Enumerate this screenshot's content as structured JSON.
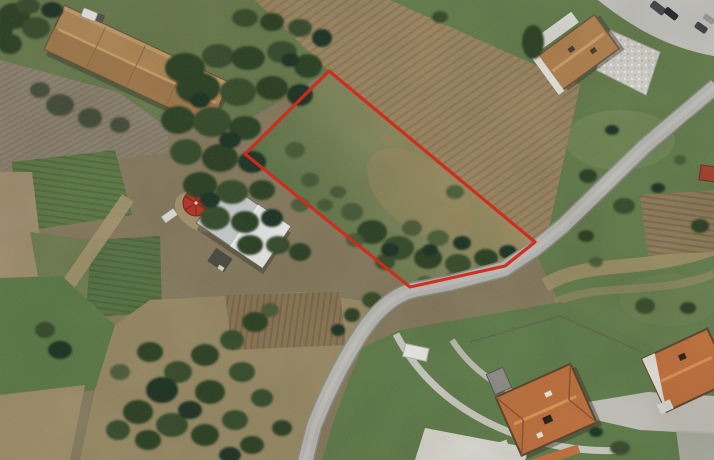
{
  "scene": {
    "type": "aerial-satellite-photo",
    "description": "Rural hillside with farm buildings, cultivated fields, a curving road and a land parcel outlined in red",
    "parcel_boundary": {
      "color": "#d32a1c",
      "stroke_width": 3.2,
      "points": "329,71 535,242 505,266 410,287 245,154"
    },
    "road": {
      "color": "#b8b8b4",
      "edge_color": "#8e8e88",
      "highlight": "#c9c9c5"
    },
    "buildings": {
      "barn_roof": "#b08756",
      "white_house_roof": "#c9ced1",
      "tan_house_roof": "#b3824f",
      "orange_house_roof": "#bf6f3b",
      "hut_roof": "#a33f2a",
      "umbrella": "#b83326"
    },
    "terrain": {
      "grass": "#627c4b",
      "grass_light": "#7c8f5d",
      "dry_field": "#978964",
      "plowed_field": "#9b8560",
      "plowed_gray": "#8c8270",
      "trees": "#2b4024"
    },
    "features": [
      "long farm barn with tan roof (top left)",
      "white-roof farmhouse with red round canopy (center left)",
      "tan-roof house with cobbled patio and parked cars (top right)",
      "two orange-roof houses with driveway and terraced garden (bottom right)",
      "gray country road crossing diagonally",
      "red boundary outline of grassy parcel (center)",
      "crop rows and plowed fields (left)",
      "tree clusters throughout"
    ],
    "vehicles": {
      "parked_cars_top_right": 4,
      "white_cars_near_farm": 2
    }
  }
}
